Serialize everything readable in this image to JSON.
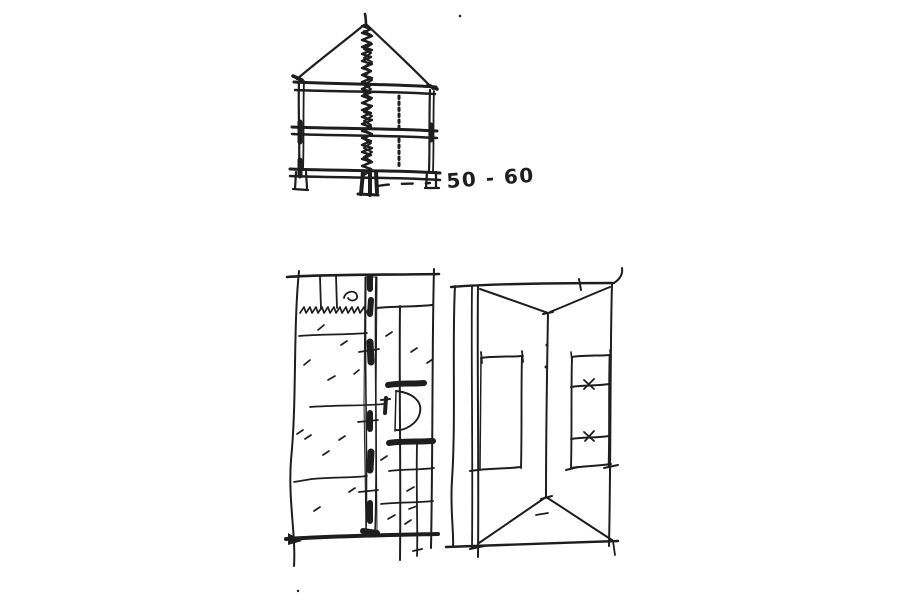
{
  "colors": {
    "ink": "#1e1e1e",
    "paper": "#ffffff"
  },
  "annotation": {
    "dimension_label": "50 - 60"
  },
  "sketches": {
    "section": "building-section-sketch",
    "floor_plan": "floor-plan-sketch",
    "roof_plan": "roof-plan-sketch"
  }
}
